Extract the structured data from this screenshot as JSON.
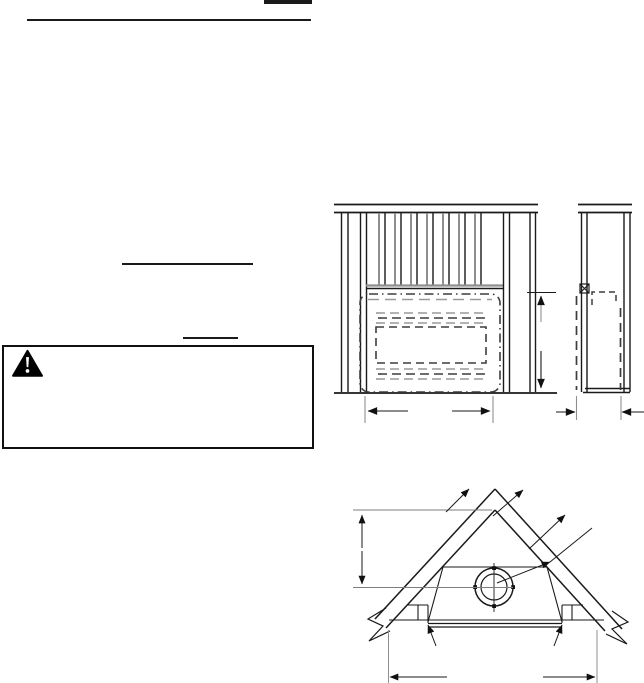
{
  "colors": {
    "background": "#ffffff",
    "ink": "#1a1a1a",
    "muted_line": "#8f8f8f",
    "warning_icon": "#000000"
  },
  "header": {
    "page_number_text": "",
    "section_title_text": ""
  },
  "body_text": {
    "subheading_1_text": "",
    "subheading_2_text": ""
  },
  "warning_box": {
    "icon": "warning-triangle-icon",
    "warning_text": ""
  },
  "figures": [
    {
      "id": "framing-front-view"
    },
    {
      "id": "framing-side-view"
    },
    {
      "id": "attic-framing-view"
    }
  ]
}
